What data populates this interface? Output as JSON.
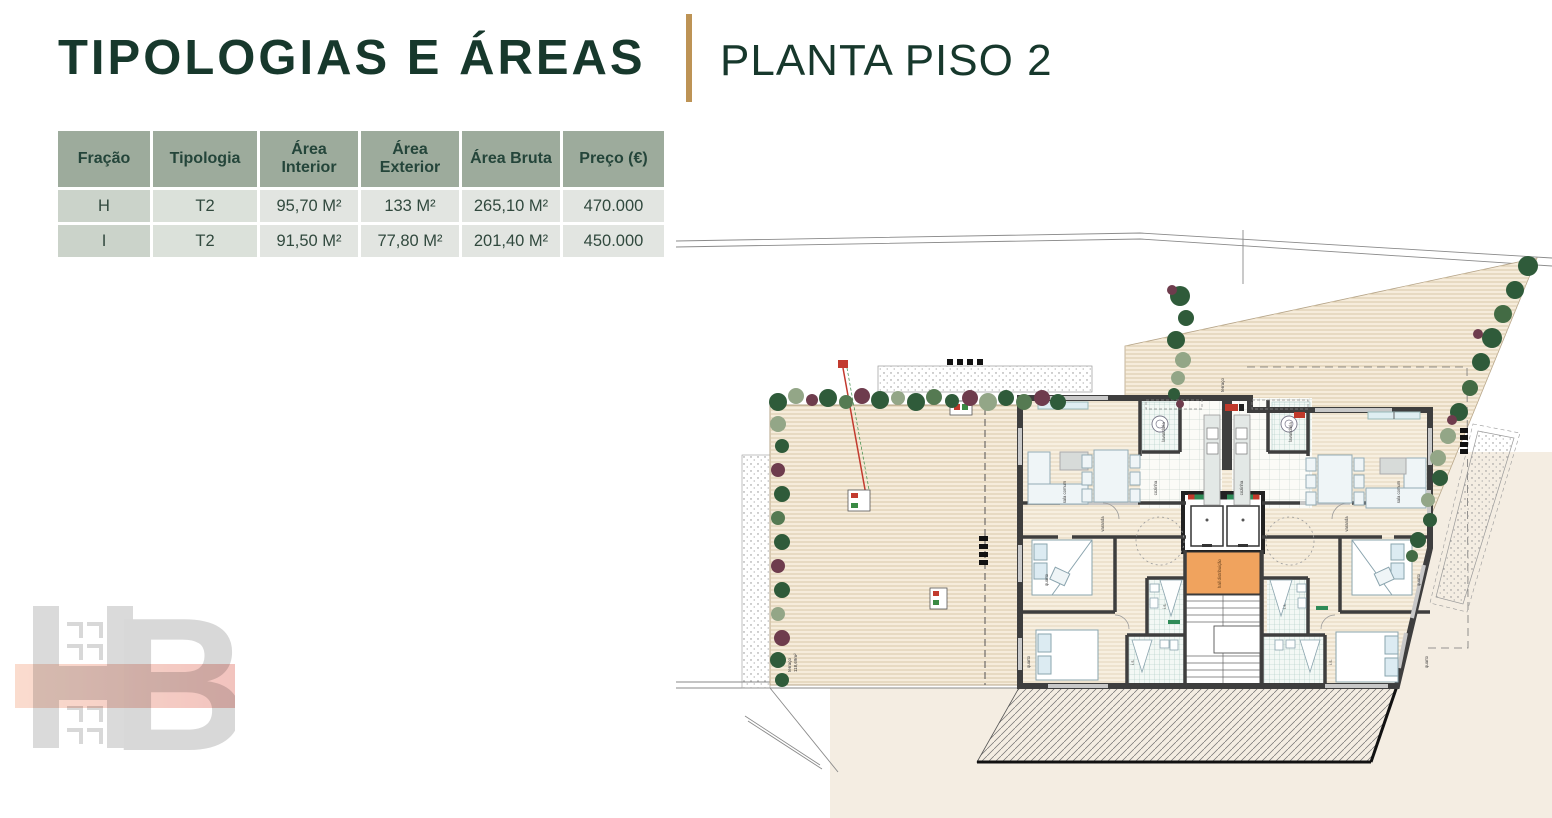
{
  "header": {
    "title": "TIPOLOGIAS E ÁREAS",
    "subtitle": "PLANTA PISO 2"
  },
  "table": {
    "headers": [
      "Fração",
      "Tipologia",
      "Área Interior",
      "Área Exterior",
      "Área Bruta",
      "Preço (€)"
    ],
    "rows": [
      {
        "fracao": "H",
        "tipologia": "T2",
        "area_interior": "95,70 M²",
        "area_exterior": "133 M²",
        "area_bruta": "265,10 M²",
        "preco": "470.000"
      },
      {
        "fracao": "I",
        "tipologia": "T2",
        "area_interior": "91,50 M²",
        "area_exterior": "77,80 M²",
        "area_bruta": "201,40 M²",
        "preco": "450.000"
      }
    ]
  },
  "plan": {
    "labels": {
      "terrace_left": "terraço",
      "terrace_left_area": "118,69m²",
      "terrace_right": "terraço",
      "sala": "sala comum",
      "cozinha": "cozinha",
      "lavandaria": "lavandaria",
      "hall": "hall distribuição",
      "varanda": "varanda",
      "quarto": "quarto",
      "wc": "i.s."
    }
  },
  "logo": {
    "b": "B"
  },
  "colors": {
    "title_green": "#17382c",
    "divider_gold": "#bd9355",
    "table_header_bg": "#9dab9c",
    "hall_orange": "#f0a35e",
    "deck_beige": "#f6ecdb",
    "background_beige": "#f4ede2",
    "wall_gray": "#3e3e3e"
  }
}
